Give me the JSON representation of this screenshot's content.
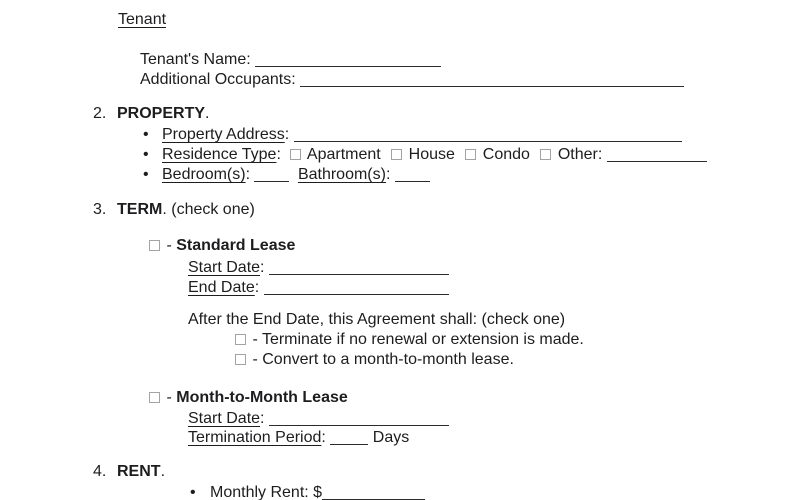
{
  "punct": {
    "bullet": "•",
    "colon": ":",
    "period": ".",
    "dash": "-"
  },
  "tenant_block": {
    "heading": "Tenant",
    "tenants_name_label": "Tenant's Name",
    "additional_occupants_label": "Additional Occupants"
  },
  "property_section": {
    "number": "2.",
    "title": "PROPERTY",
    "address_label": "Property Address",
    "residence_type_label": "Residence Type",
    "options": [
      "Apartment",
      "House",
      "Condo"
    ],
    "other_label": "Other",
    "bedrooms_label": "Bedroom(s)",
    "bathrooms_label": "Bathroom(s)"
  },
  "term_section": {
    "number": "3.",
    "title": "TERM",
    "instruction": "(check one)",
    "standard": {
      "title": "Standard Lease",
      "start_date_label": "Start Date",
      "end_date_label": "End Date"
    },
    "after_clause": "After the End Date, this Agreement shall: (check one)",
    "option_terminate": "Terminate if no renewal or extension is made.",
    "option_convert": "Convert to a month-to-month lease.",
    "mtm": {
      "title": "Month-to-Month Lease",
      "start_date_label": "Start Date",
      "termination_label": "Termination Period",
      "days_suffix": "Days"
    }
  },
  "rent_section": {
    "number": "4.",
    "title": "RENT",
    "monthly_rent_label": "Monthly Rent",
    "currency": "$"
  }
}
